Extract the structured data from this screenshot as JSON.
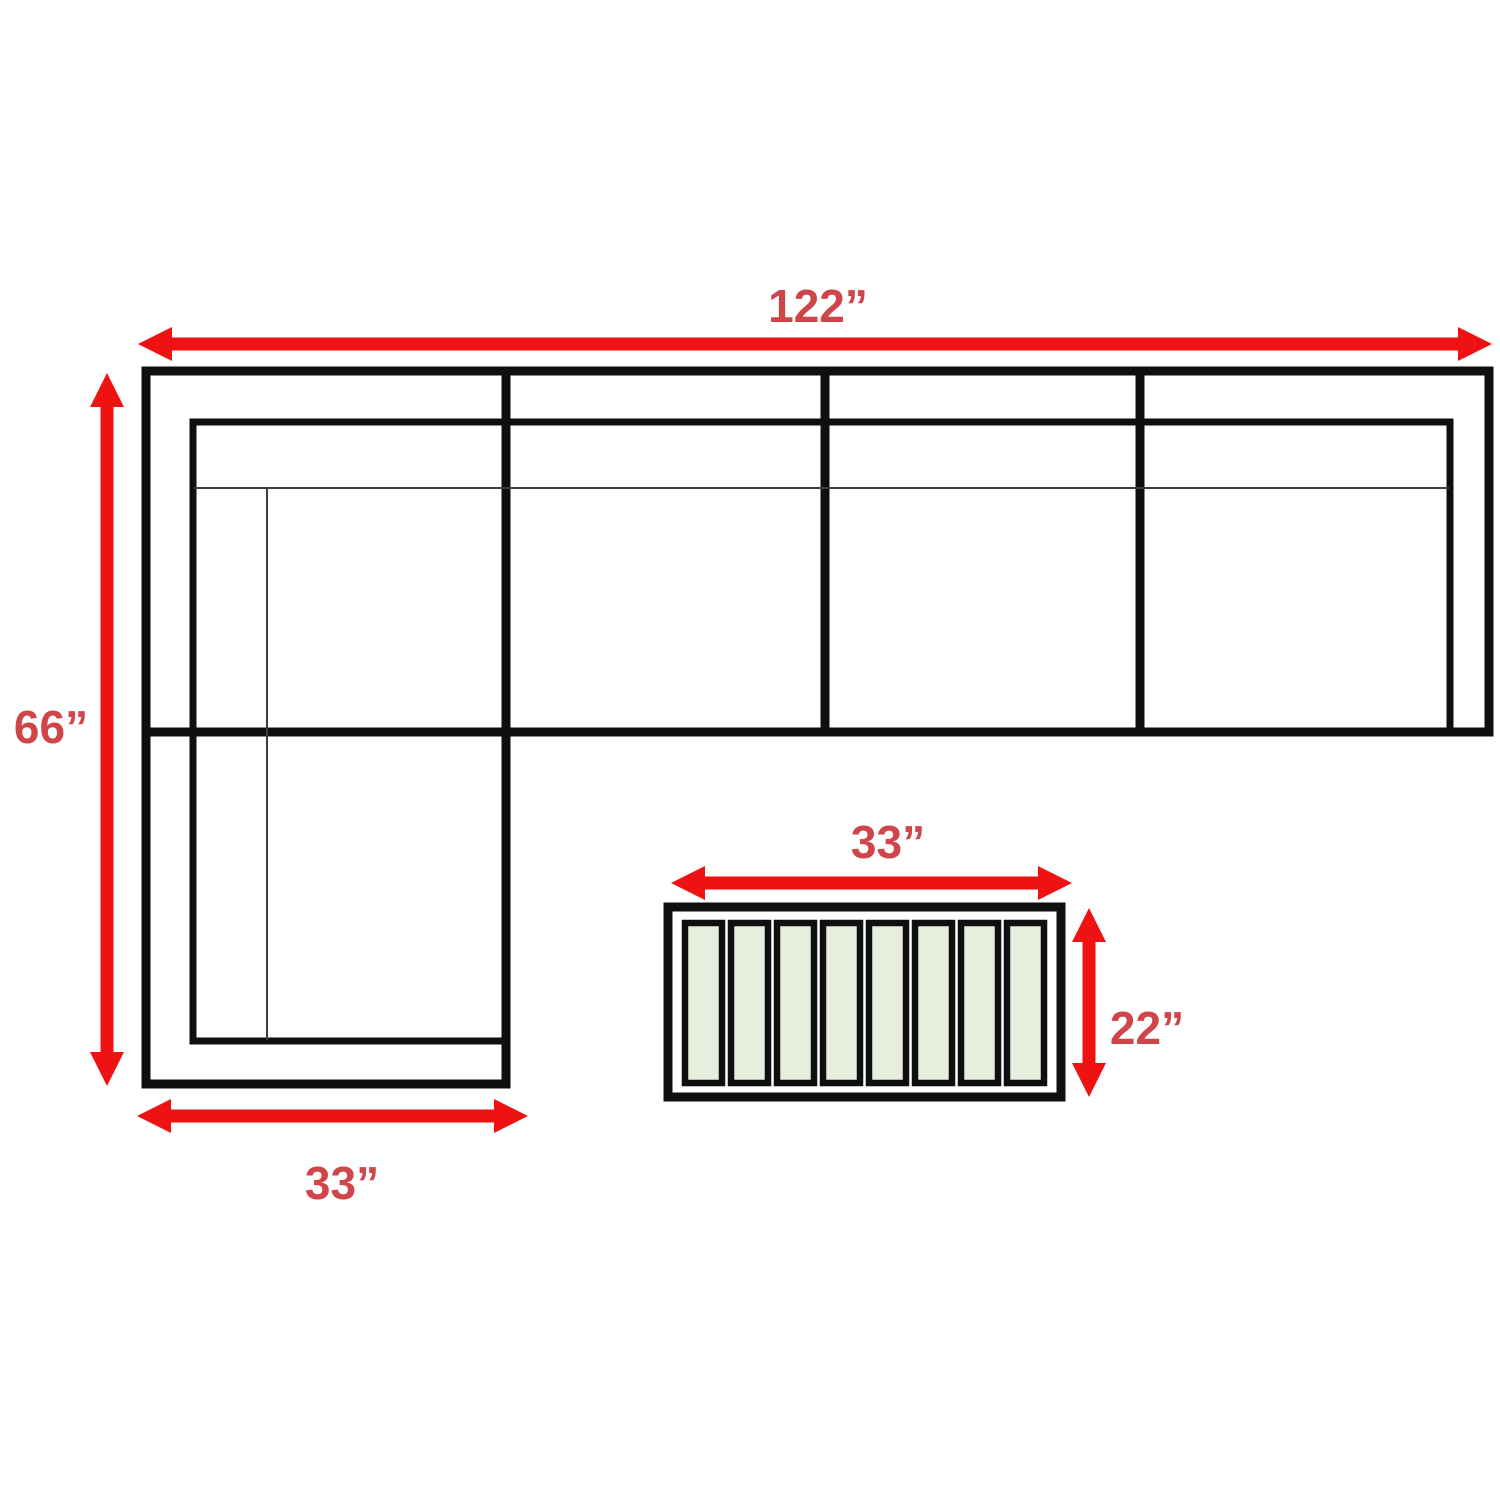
{
  "diagram": {
    "type": "furniture-dimension-diagram",
    "colors": {
      "arrow_red": "#ee1212",
      "label_red": "#cf4549",
      "outline_black": "#0f0f0f",
      "slat_green": "#e6efde",
      "background": "#ffffff"
    },
    "sofa": {
      "seat_sections": 4,
      "shape": "L-shaped sectional with left chaise",
      "dimensions": {
        "width": {
          "label": "122”",
          "value": 122,
          "unit": "in"
        },
        "depth_with_chaise": {
          "label": "66”",
          "value": 66,
          "unit": "in"
        },
        "chaise_width": {
          "label": "33”",
          "value": 33,
          "unit": "in"
        }
      }
    },
    "coffee_table": {
      "slat_count": 8,
      "dimensions": {
        "width": {
          "label": "33”",
          "value": 33,
          "unit": "in"
        },
        "depth": {
          "label": "22”",
          "value": 22,
          "unit": "in"
        }
      }
    }
  }
}
